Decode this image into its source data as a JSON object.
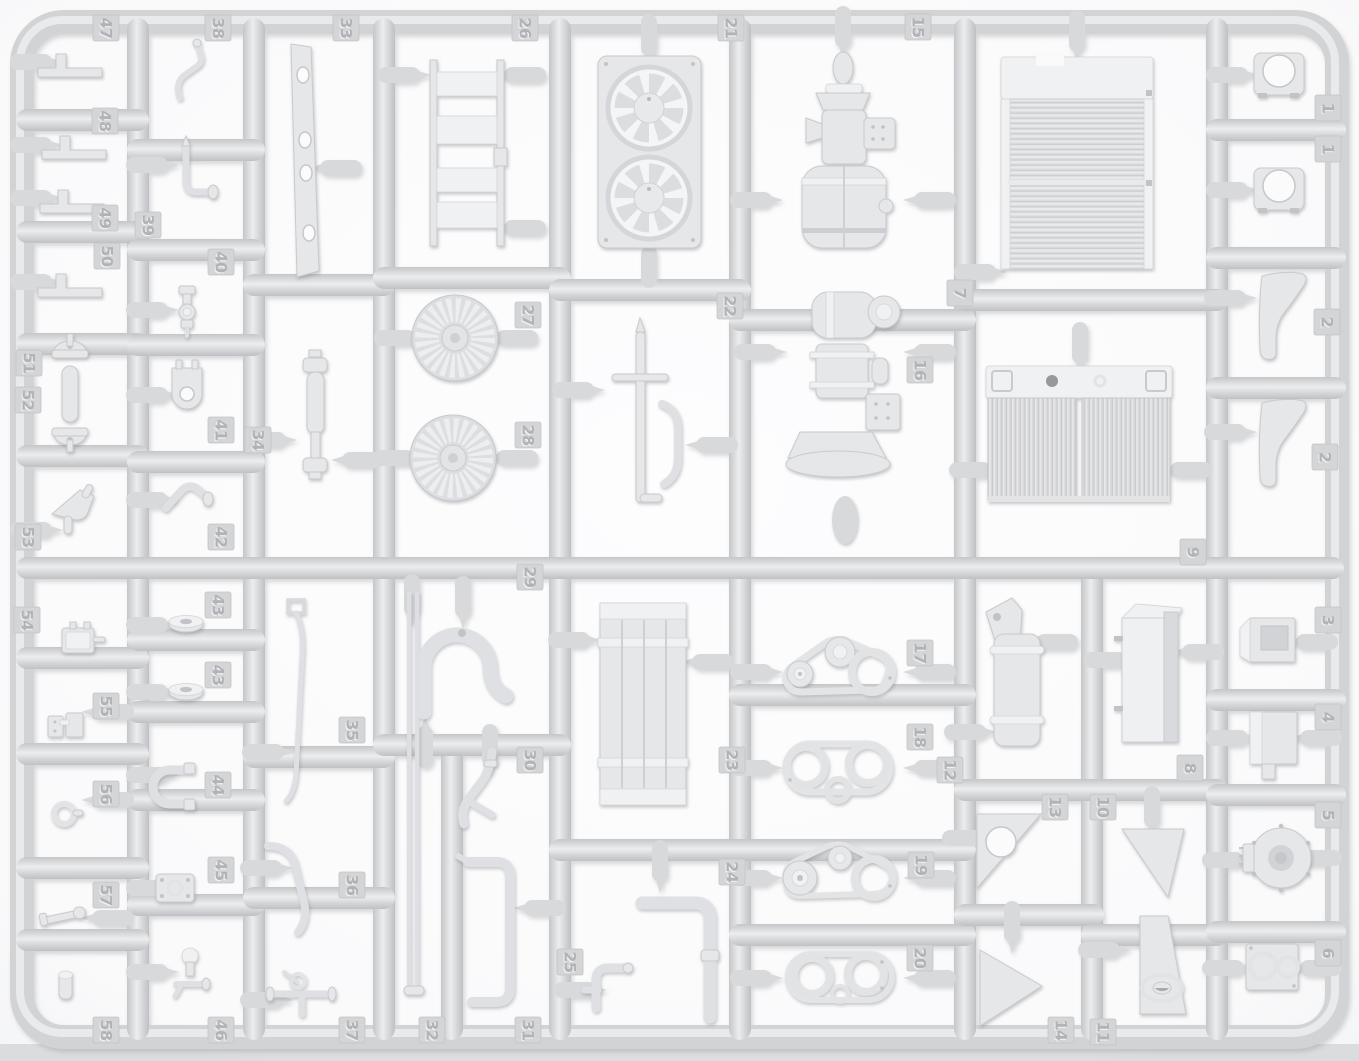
{
  "image": {
    "description": "top-down photo of a light grey injection-molded model kit parts sprue",
    "plastic_color_name": "light grey"
  },
  "colors": {
    "background": "#fbfbfc",
    "frame": "#d2d3d5",
    "frame_highlight": "#e9eaec",
    "part_fill": "#e6e7e9",
    "part_shade": "#cfd0d3",
    "tag_fill": "#d4d5d7",
    "tag_text_shadow": "#b2b3b7",
    "tag_text_highlight": "#f1f2f3",
    "bottom_band": "#d6d7d9"
  },
  "tags": [
    {
      "label": "47",
      "x": 106,
      "y": 28,
      "part": "angle-bracket"
    },
    {
      "label": "48",
      "x": 105,
      "y": 121,
      "part": "angle-bracket"
    },
    {
      "label": "49",
      "x": 105,
      "y": 218,
      "part": "angle-bracket"
    },
    {
      "label": "50",
      "x": 107,
      "y": 256,
      "part": "angle-bracket"
    },
    {
      "label": "51",
      "x": 29,
      "y": 363,
      "part": "bearing-cap"
    },
    {
      "label": "52",
      "x": 28,
      "y": 400,
      "part": "bearing-cap"
    },
    {
      "label": "53",
      "x": 28,
      "y": 537,
      "part": "funnel-scoop"
    },
    {
      "label": "54",
      "x": 27,
      "y": 620,
      "part": "junction-box"
    },
    {
      "label": "55",
      "x": 106,
      "y": 706,
      "part": "twin-box"
    },
    {
      "label": "56",
      "x": 106,
      "y": 794,
      "part": "ring-grommet"
    },
    {
      "label": "57",
      "x": 106,
      "y": 895,
      "part": "linkage-arm"
    },
    {
      "label": "58",
      "x": 106,
      "y": 1030,
      "part": "small-cylinder-fitting"
    },
    {
      "label": "38",
      "x": 218,
      "y": 28,
      "part": "bent-wire-rod"
    },
    {
      "label": "39",
      "x": 148,
      "y": 225,
      "part": "elbow-tube"
    },
    {
      "label": "40",
      "x": 221,
      "y": 262,
      "part": "valve-stack"
    },
    {
      "label": "41",
      "x": 221,
      "y": 430,
      "part": "clevis-fork"
    },
    {
      "label": "42",
      "x": 221,
      "y": 537,
      "part": "angled-fitting"
    },
    {
      "label": "43",
      "x": 218,
      "y": 605,
      "part": "pulley-wheel"
    },
    {
      "label": "43",
      "x": 218,
      "y": 675,
      "part": "pulley-wheel"
    },
    {
      "label": "44",
      "x": 218,
      "y": 785,
      "part": "u-hose"
    },
    {
      "label": "45",
      "x": 221,
      "y": 870,
      "part": "gasket-plate"
    },
    {
      "label": "46",
      "x": 221,
      "y": 1030,
      "part": "drain-valve"
    },
    {
      "label": "33",
      "x": 346,
      "y": 28,
      "part": "mounting-strip"
    },
    {
      "label": "34",
      "x": 258,
      "y": 440,
      "part": "drive-shaft"
    },
    {
      "label": "35",
      "x": 352,
      "y": 730,
      "part": "control-rod"
    },
    {
      "label": "36",
      "x": 352,
      "y": 885,
      "part": "curved-pipe"
    },
    {
      "label": "37",
      "x": 352,
      "y": 1030,
      "part": "pipe-manifold"
    },
    {
      "label": "26",
      "x": 525,
      "y": 28,
      "part": "ladder-frame"
    },
    {
      "label": "27",
      "x": 528,
      "y": 315,
      "part": "turbine-wheel"
    },
    {
      "label": "28",
      "x": 528,
      "y": 435,
      "part": "turbine-wheel"
    },
    {
      "label": "29",
      "x": 530,
      "y": 577,
      "part": "u-pipe"
    },
    {
      "label": "30",
      "x": 530,
      "y": 760,
      "part": "branch-pipe"
    },
    {
      "label": "32",
      "x": 432,
      "y": 1030,
      "part": "twin-rods"
    },
    {
      "label": "31",
      "x": 528,
      "y": 1030,
      "part": "z-pipe"
    },
    {
      "label": "21",
      "x": 731,
      "y": 28,
      "part": "dual-fan-shroud"
    },
    {
      "label": "22",
      "x": 730,
      "y": 306,
      "part": "pipe-assembly"
    },
    {
      "label": "23",
      "x": 732,
      "y": 760,
      "part": "cooler-core"
    },
    {
      "label": "24",
      "x": 732,
      "y": 872,
      "part": "l-pipe"
    },
    {
      "label": "25",
      "x": 570,
      "y": 962,
      "part": "t-fitting"
    },
    {
      "label": "15",
      "x": 918,
      "y": 27,
      "part": "compressor-unit"
    },
    {
      "label": "16",
      "x": 920,
      "y": 370,
      "part": "compressor-unit"
    },
    {
      "label": "17",
      "x": 920,
      "y": 653,
      "part": "belt-pulley-set"
    },
    {
      "label": "18",
      "x": 920,
      "y": 737,
      "part": "belt-pulley-set"
    },
    {
      "label": "19",
      "x": 921,
      "y": 865,
      "part": "belt-pulley-set"
    },
    {
      "label": "20",
      "x": 920,
      "y": 958,
      "part": "belt-pulley-set"
    },
    {
      "label": "7",
      "x": 960,
      "y": 293,
      "part": "radiator"
    },
    {
      "label": "9",
      "x": 1193,
      "y": 552,
      "part": "radiator-core-pair"
    },
    {
      "label": "12",
      "x": 950,
      "y": 770,
      "part": "cylindrical-tank"
    },
    {
      "label": "8",
      "x": 1190,
      "y": 768,
      "part": "rectangular-tank"
    },
    {
      "label": "13",
      "x": 1055,
      "y": 807,
      "part": "triangular-gusset"
    },
    {
      "label": "10",
      "x": 1103,
      "y": 807,
      "part": "triangular-gusset"
    },
    {
      "label": "14",
      "x": 1061,
      "y": 1030,
      "part": "triangular-gusset"
    },
    {
      "label": "11",
      "x": 1103,
      "y": 1032,
      "part": "wedge-bracket"
    },
    {
      "label": "1",
      "x": 1328,
      "y": 108,
      "part": "hole-bracket"
    },
    {
      "label": "1",
      "x": 1328,
      "y": 149,
      "part": "hole-bracket"
    },
    {
      "label": "2",
      "x": 1327,
      "y": 322,
      "part": "curved-fender"
    },
    {
      "label": "2",
      "x": 1325,
      "y": 457,
      "part": "curved-fender"
    },
    {
      "label": "3",
      "x": 1328,
      "y": 620,
      "part": "recessed-box"
    },
    {
      "label": "4",
      "x": 1328,
      "y": 717,
      "part": "tab-box"
    },
    {
      "label": "5",
      "x": 1328,
      "y": 815,
      "part": "fan-housing"
    },
    {
      "label": "6",
      "x": 1328,
      "y": 953,
      "part": "twin-port-plate"
    }
  ]
}
